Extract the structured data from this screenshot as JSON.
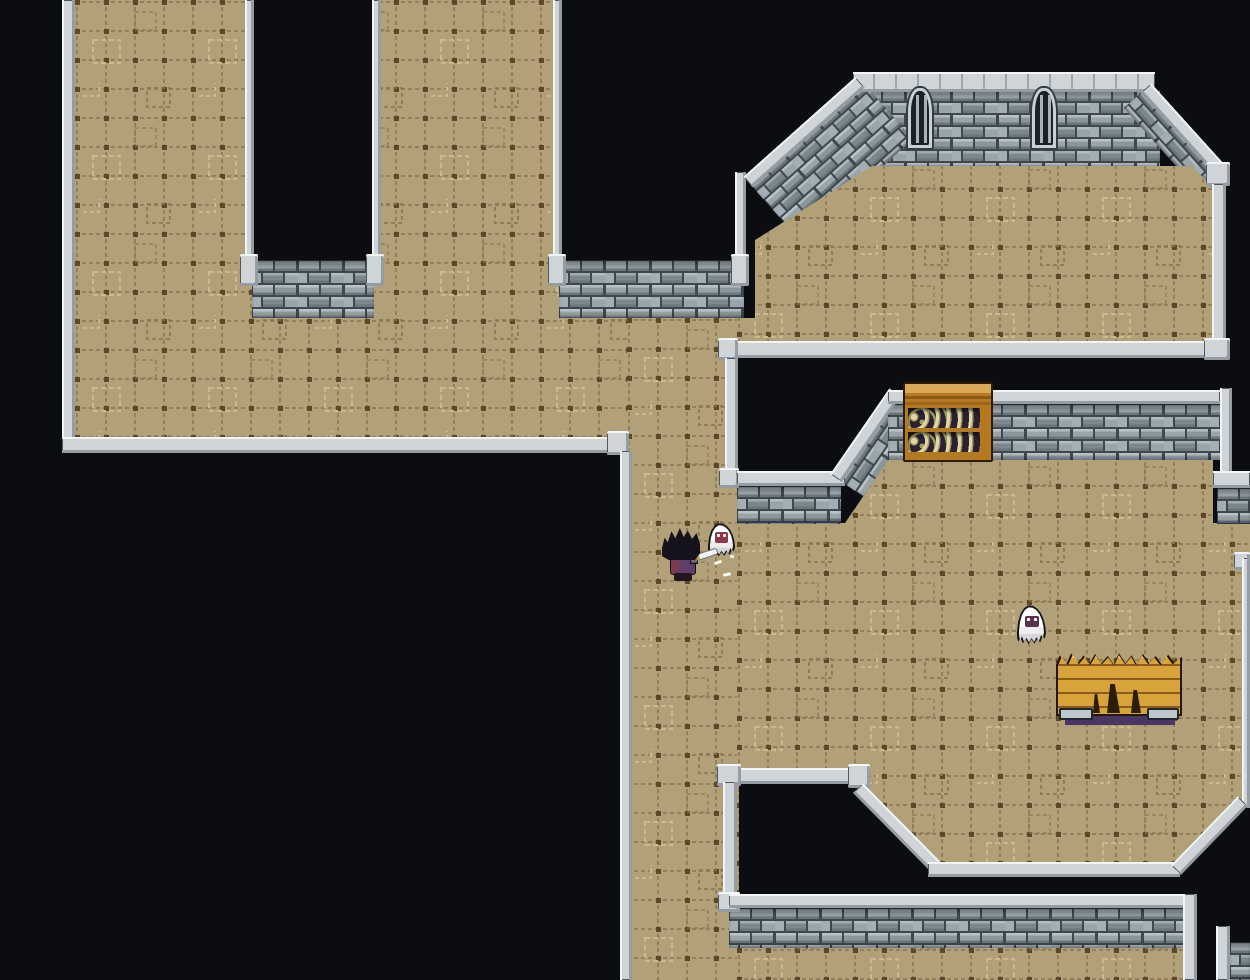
{
  "app": {
    "name": "Pixel Dungeon Game",
    "view": "top-down dungeon scene",
    "hud_text": ""
  },
  "palette": {
    "bg": "#0c0d11",
    "floorBase": "#b1a078",
    "floorLine": "#8a7550",
    "floorDot": "#5d4729",
    "floorDecoLight": "#c9ba90",
    "mortar": "#3f484e",
    "brick1": "#9aa5ab",
    "brick2": "#8b969c",
    "brick3": "#a4afb5",
    "brick4": "#7b868d",
    "brickHi": "#b9c3c8",
    "brickLo": "#6b757c",
    "cap": "#ced4d7",
    "capHi": "#f1f5f6",
    "capLo": "#969da2",
    "capOutline": "#4f565c",
    "shelfWood": "#b5791f",
    "shelfWoodHi": "#d9a757",
    "shelfBg": "#2a2134",
    "bone1": "#e3d7a6",
    "bone2": "#a89c66",
    "bone3": "#9aa05e",
    "benchWood": "#d9a33c",
    "benchWoodLo": "#8a5c1a",
    "benchCrack": "#2b1d08",
    "benchShadow": "#4a3663",
    "ghostOutline": "#17171a",
    "ghostFaceA": "#8e3a4a",
    "ghostFaceB": "#5a3150",
    "hair": "#15121b",
    "robeL": "#7a3b50",
    "robeR": "#5e3f68",
    "blade": "#f5f7f7",
    "window": "#1b2126",
    "windowBar": "#a7b4bb"
  },
  "scene": {
    "background": "#0c0d11",
    "tileset": {
      "floor": "tan stone tiles with dashed grid and square etchings",
      "wall": "gray stone brick walls with light gray caps",
      "void": "black unexplored space"
    },
    "entities": [
      {
        "id": "player",
        "label": "hero swinging sword",
        "x": 668,
        "y": 540,
        "facing": "right"
      },
      {
        "id": "ghost-small",
        "label": "small ghost enemy near player",
        "x": 712,
        "y": 527
      },
      {
        "id": "ghost",
        "label": "ghost enemy in east room",
        "x": 1020,
        "y": 608
      }
    ],
    "props": [
      {
        "id": "skull-shelf",
        "label": "wooden shelf stacked with skulls and bones",
        "x": 903,
        "y": 382
      },
      {
        "id": "broken-table",
        "label": "broken wooden table with splintered top",
        "x": 1055,
        "y": 650
      },
      {
        "id": "barred-window-1",
        "label": "arched barred window",
        "x": 906,
        "y": 86
      },
      {
        "id": "barred-window-2",
        "label": "arched barred window",
        "x": 1030,
        "y": 86
      }
    ],
    "effects": [
      {
        "id": "slash-particles",
        "label": "white slash particles from sword",
        "x": 718,
        "y": 566
      }
    ]
  }
}
